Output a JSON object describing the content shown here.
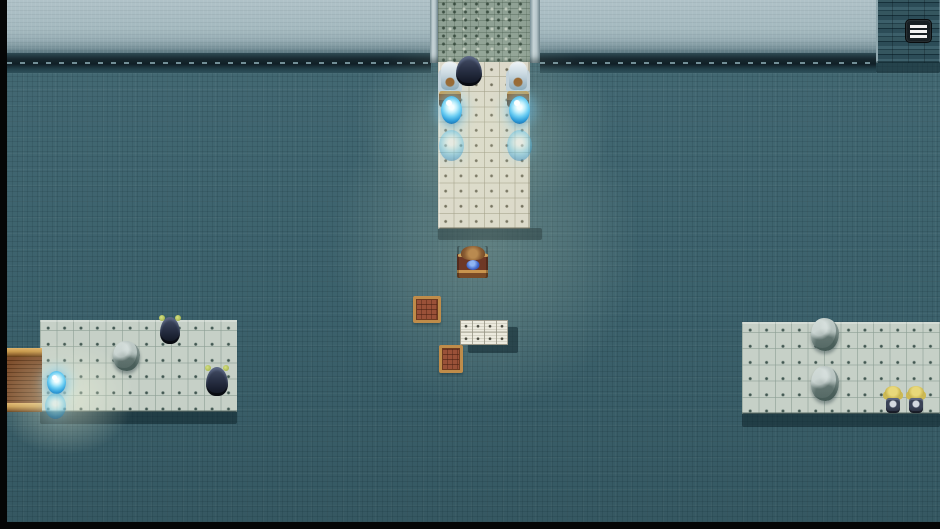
{
  "hud": {
    "menu_button": {
      "icon": "hamburger-menu",
      "bars": 3
    }
  },
  "palette": {
    "floor_teal": "#3e6570",
    "wall_light": "#a9bdc3",
    "wall_trim_dark": "#17282f",
    "tower_dark": "#2f4f5a",
    "cobble_path": "#8fa194",
    "walkway_tile": "#dbd7c9",
    "platform_tile": "#c6d0c7",
    "white_tile": "#eceade",
    "cast_shadow": "#0e242c",
    "crystal_blue": "#69ccf2",
    "wood_brown": "#7e4e2c",
    "gold_trim": "#c79a4e",
    "letterbox_black": "#050606"
  },
  "scene": {
    "setting": "top-down tiled courtyard with entrance walkway, side platforms, statues, crystals and NPCs",
    "objects": [
      {
        "name": "wall-upper-left",
        "type": "wall",
        "x": 7,
        "y": 0,
        "w": 424,
        "h": 55,
        "i": false
      },
      {
        "name": "wall-upper-right",
        "type": "wall",
        "x": 540,
        "y": 0,
        "w": 336,
        "h": 55,
        "i": false
      },
      {
        "name": "wall-ledge-left",
        "type": "wall-trim",
        "x": 7,
        "y": 53,
        "w": 424,
        "h": 20,
        "i": false
      },
      {
        "name": "wall-ledge-right",
        "type": "wall-trim",
        "x": 540,
        "y": 53,
        "w": 336,
        "h": 20,
        "i": false
      },
      {
        "name": "corner-tower",
        "type": "tower",
        "x": 876,
        "y": 0,
        "w": 64,
        "h": 63,
        "i": false
      },
      {
        "name": "tower-base-shadow",
        "type": "cast-shadow",
        "x": 876,
        "y": 61,
        "w": 64,
        "h": 12,
        "i": false
      },
      {
        "name": "door-jamb-left",
        "type": "jamb",
        "x": 430,
        "y": 0,
        "w": 8,
        "h": 63,
        "i": false
      },
      {
        "name": "door-jamb-right",
        "type": "jamb",
        "x": 530,
        "y": 0,
        "w": 10,
        "h": 63,
        "i": false
      },
      {
        "name": "stone-entry-path",
        "type": "stone-path",
        "x": 438,
        "y": 0,
        "w": 92,
        "h": 63,
        "i": true
      },
      {
        "name": "entry-walkway",
        "type": "walkway",
        "x": 438,
        "y": 62,
        "w": 92,
        "h": 167,
        "i": true
      },
      {
        "name": "walkway-shadow",
        "type": "cast-shadow",
        "x": 438,
        "y": 228,
        "w": 104,
        "h": 12,
        "i": false
      },
      {
        "name": "left-platform",
        "type": "platform",
        "x": 40,
        "y": 320,
        "w": 197,
        "h": 92,
        "i": true
      },
      {
        "name": "left-platform-shadow",
        "type": "cast-shadow",
        "x": 40,
        "y": 411,
        "w": 197,
        "h": 13,
        "i": false
      },
      {
        "name": "wooden-dock-bridge",
        "type": "bridge",
        "x": 7,
        "y": 348,
        "w": 35,
        "h": 64,
        "i": true
      },
      {
        "name": "right-platform",
        "type": "platform",
        "x": 742,
        "y": 322,
        "w": 198,
        "h": 92,
        "i": true
      },
      {
        "name": "right-platform-shadow",
        "type": "cast-shadow",
        "x": 742,
        "y": 413,
        "w": 198,
        "h": 14,
        "i": false
      },
      {
        "name": "center-glow-upper",
        "type": "glow-soft",
        "x": 355,
        "y": 30,
        "w": 260,
        "h": 180,
        "i": false
      },
      {
        "name": "center-glow-main",
        "type": "glow-soft",
        "x": 330,
        "y": 80,
        "w": 310,
        "h": 330,
        "i": false
      },
      {
        "name": "dock-glow",
        "type": "glow-strong",
        "x": -5,
        "y": 340,
        "w": 140,
        "h": 115,
        "i": false
      },
      {
        "name": "angel-statue-left",
        "type": "angel-statue",
        "x": 437,
        "y": 62,
        "w": 25,
        "h": 45,
        "i": false
      },
      {
        "name": "angel-statue-right",
        "type": "angel-statue",
        "x": 505,
        "y": 62,
        "w": 25,
        "h": 45,
        "i": false
      },
      {
        "name": "hooded-npc-entrance",
        "type": "hooded-npc",
        "x": 456,
        "y": 56,
        "w": 26,
        "h": 30,
        "i": true
      },
      {
        "name": "save-crystal-entrance-left",
        "type": "orb-bright",
        "x": 441,
        "y": 96,
        "w": 21,
        "h": 28,
        "i": true
      },
      {
        "name": "save-crystal-entrance-right",
        "type": "orb-bright",
        "x": 509,
        "y": 96,
        "w": 21,
        "h": 28,
        "i": true
      },
      {
        "name": "faded-crystal-entrance-left",
        "type": "orb-faint",
        "x": 439,
        "y": 130,
        "w": 25,
        "h": 31,
        "i": true
      },
      {
        "name": "faded-crystal-entrance-right",
        "type": "orb-faint",
        "x": 507,
        "y": 130,
        "w": 25,
        "h": 31,
        "i": true
      },
      {
        "name": "seated-character-desk",
        "type": "desk-character",
        "x": 457,
        "y": 246,
        "w": 31,
        "h": 32,
        "i": true
      },
      {
        "name": "wooden-crate-upper",
        "type": "crate",
        "x": 413,
        "y": 296,
        "w": 28,
        "h": 27,
        "i": true
      },
      {
        "name": "white-tiles-shadow",
        "type": "cast-shadow",
        "x": 468,
        "y": 327,
        "w": 50,
        "h": 26,
        "i": false
      },
      {
        "name": "white-tile-block",
        "type": "white-tiles",
        "x": 460,
        "y": 320,
        "w": 48,
        "h": 25,
        "i": true
      },
      {
        "name": "wooden-crate-lower",
        "type": "crate",
        "x": 439,
        "y": 345,
        "w": 24,
        "h": 28,
        "i": true
      },
      {
        "name": "stone-figure-left-platform",
        "type": "rock-statue",
        "x": 113,
        "y": 341,
        "w": 27,
        "h": 30,
        "i": true
      },
      {
        "name": "imp-npc-upper",
        "type": "imp-npc",
        "x": 160,
        "y": 317,
        "w": 20,
        "h": 27,
        "i": true
      },
      {
        "name": "imp-npc-lower",
        "type": "imp-npc",
        "x": 206,
        "y": 367,
        "w": 22,
        "h": 29,
        "i": true
      },
      {
        "name": "save-crystal-dock",
        "type": "orb-bright",
        "x": 47,
        "y": 371,
        "w": 19,
        "h": 23,
        "i": true
      },
      {
        "name": "faded-crystal-dock",
        "type": "orb-faint",
        "x": 45,
        "y": 393,
        "w": 21,
        "h": 26,
        "i": true
      },
      {
        "name": "stone-figure-right-upper",
        "type": "rock-statue",
        "x": 811,
        "y": 318,
        "w": 28,
        "h": 33,
        "i": true
      },
      {
        "name": "stone-figure-right-lower",
        "type": "rock-statue",
        "x": 811,
        "y": 366,
        "w": 28,
        "h": 35,
        "i": true
      },
      {
        "name": "blond-npc-left",
        "type": "blond-npc",
        "x": 884,
        "y": 386,
        "w": 18,
        "h": 27,
        "i": true
      },
      {
        "name": "blond-npc-right",
        "type": "blond-npc",
        "x": 906,
        "y": 386,
        "w": 20,
        "h": 27,
        "i": true
      }
    ]
  }
}
